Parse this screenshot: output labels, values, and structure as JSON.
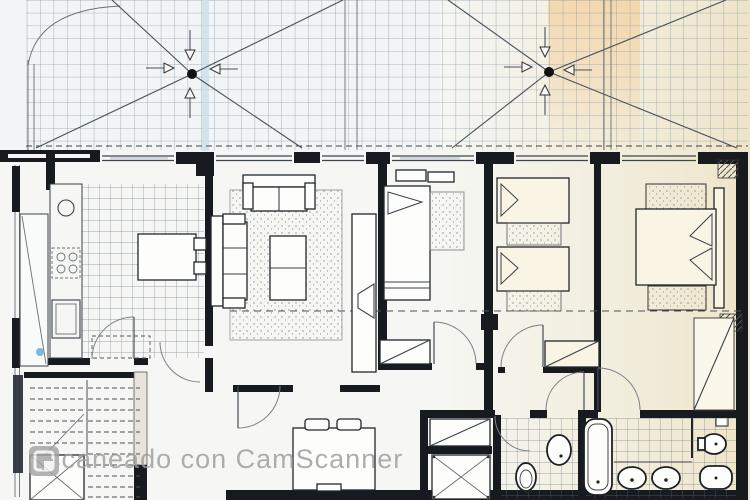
{
  "watermark": {
    "text": "Escaneado con CamScanner",
    "icon": "camscanner-icon",
    "color": "#9d9d9d"
  },
  "icons": {
    "drain": "drain-icon",
    "flow_arrow": "flow-arrow-icon",
    "camscanner": "camscanner-icon"
  },
  "colors": {
    "paper": "#f6f7f4",
    "cream": "#efe6cb",
    "orange_streak": "#f4c98e",
    "grid_blue": "#7e93a4",
    "ink": "#3a4149",
    "wall_black": "#171a1f",
    "watermark_gray": "#9d9d9d",
    "crease_blue": "#c9dcea",
    "droplet_blue": "#7fb6da"
  }
}
